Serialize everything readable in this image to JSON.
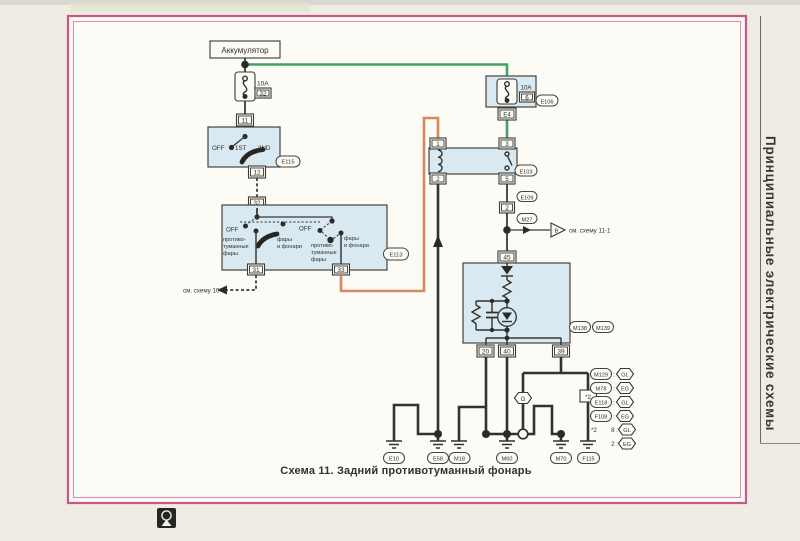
{
  "page": {
    "caption": "Схема 11. Задний противотуманный фонарь",
    "sidebar_title": "Принципиальные электрические схемы"
  },
  "colors": {
    "feed_wire_green": "#44a162",
    "switched_wire_orange": "#d6895f",
    "component_fill_blue": "#d8e9f1",
    "frame_pink": "#c75689"
  },
  "diagram": {
    "battery": "Аккумулятор",
    "fuse_left": {
      "amp": "10A",
      "id": "32"
    },
    "connectors": {
      "c11": "11",
      "c12": "12",
      "c32": "32",
      "c31": "31",
      "c33": "33",
      "e4": "E4",
      "c2": "2",
      "c45": "45",
      "c20": "20",
      "c40": "40",
      "c39": "39"
    },
    "light_switch": {
      "off": "OFF",
      "pos1": "1ST",
      "pos2": "2ND",
      "id": "E115"
    },
    "fog_switch": {
      "id": "E113",
      "left": {
        "off": "OFF",
        "fog": [
          "противо-",
          "туманные",
          "фары"
        ],
        "lamps": [
          "фары",
          "и фонари"
        ]
      },
      "right": {
        "off": "OFF",
        "fog": [
          "противо-",
          "туманные",
          "фары"
        ],
        "lamps": [
          "фары",
          "и фонари"
        ]
      }
    },
    "fuse_right": {
      "amp": "10A",
      "id_num": "6",
      "id": "E106"
    },
    "relay": {
      "p1": "1",
      "p2": "2",
      "p3": "3",
      "p5": "5",
      "id": "E103"
    },
    "chain": {
      "top": "E109",
      "conn": "2",
      "bottom": "M27"
    },
    "notes": {
      "see10": "см. схему 10",
      "see11": "см. схему 11-1",
      "branch_letter": "B",
      "joint": "G",
      "footnote": "*2"
    },
    "lamp": {
      "id_left": "M138",
      "id_right": "M139"
    },
    "grounds": [
      "E10",
      "E58",
      "M18",
      "M60",
      "M70",
      "F115"
    ],
    "legend": {
      "sep": ":",
      "rows": [
        {
          "conn": "M129",
          "code": "GL"
        },
        {
          "conn": "M78",
          "code": "EG"
        },
        {
          "conn": "E118",
          "code": "GL"
        },
        {
          "conn": "F108",
          "code": "EG"
        }
      ],
      "note_star": "*2",
      "note_rows": [
        {
          "pin": "8 :",
          "code": "GL"
        },
        {
          "pin": "2 :",
          "code": "EG"
        }
      ]
    }
  }
}
